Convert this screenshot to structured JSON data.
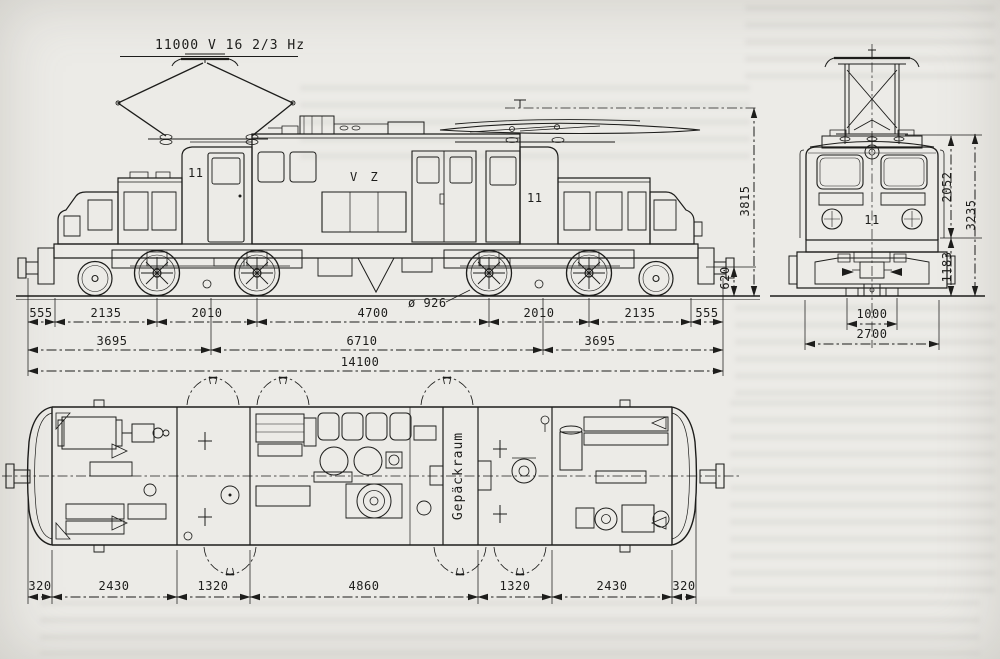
{
  "colors": {
    "paper": "#ecebe7",
    "ink": "#1d1d1b"
  },
  "labels": {
    "catenary": "11000 V  16 2/3 Hz",
    "side_cab_number_left": "11",
    "side_body_marking": "V Z",
    "side_cab_number_right": "11",
    "wheel_diameter": "ø 926",
    "front_cab_number": "11",
    "plan_compartment": "Gepäckraum"
  },
  "side_dims": {
    "row1": [
      "555",
      "2135",
      "2010",
      "4700",
      "2010",
      "2135",
      "555"
    ],
    "row2": [
      "3695",
      "6710",
      "3695"
    ],
    "total_length": "14100",
    "height_pantograph_lowered": "3815",
    "buffer_axis_height": "620"
  },
  "front_dims": {
    "cab_height": "2052",
    "body_height": "3235",
    "frame_height": "1183",
    "wheel_plane_distance": "1000",
    "body_width": "2700"
  },
  "plan_dims": {
    "row": [
      "320",
      "2430",
      "1320",
      "4860",
      "1320",
      "2430",
      "320"
    ]
  }
}
